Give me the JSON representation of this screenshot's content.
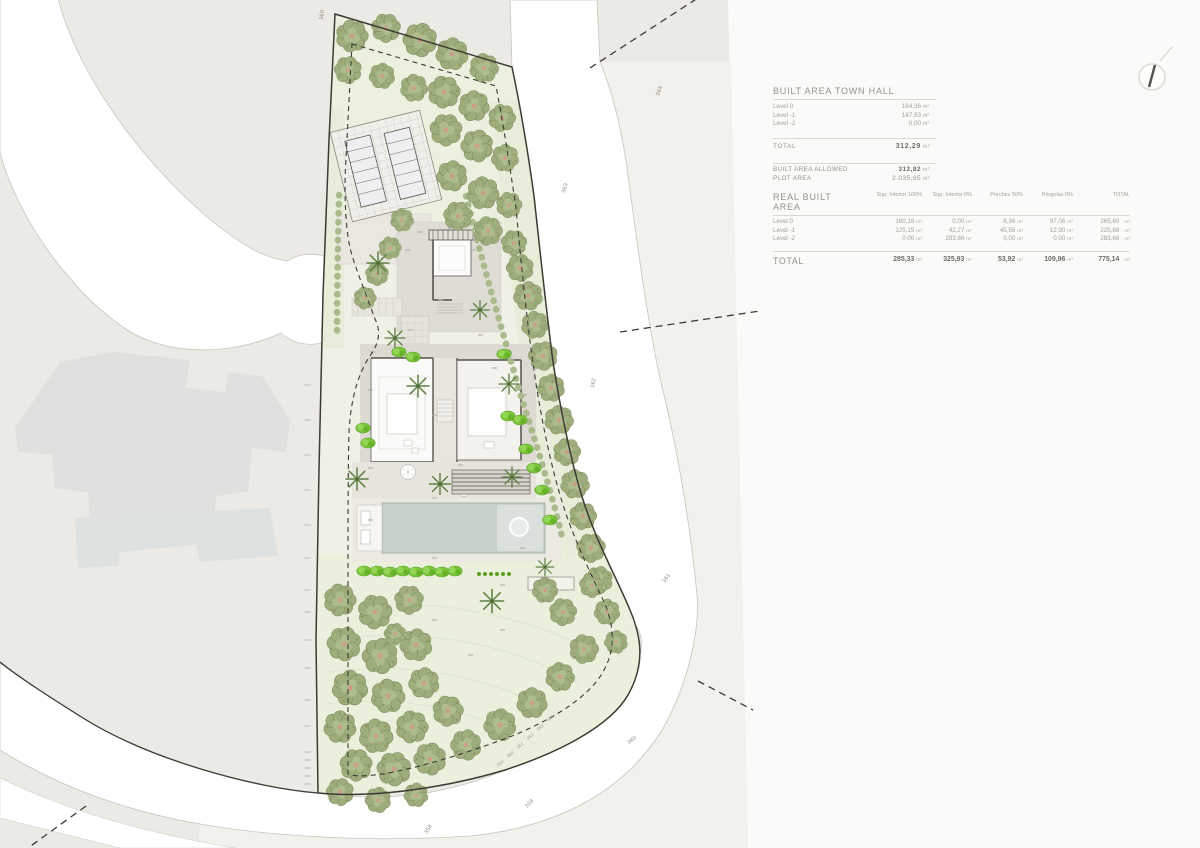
{
  "panel": {
    "unit": "m²",
    "town_hall": {
      "title": "BUILT AREA TOWN HALL",
      "rows": [
        {
          "label": "Level 0",
          "value": "164,36"
        },
        {
          "label": "Level -1",
          "value": "147,93"
        },
        {
          "label": "Level -2",
          "value": "0,00"
        }
      ],
      "total_label": "TOTAL",
      "total_value": "312,29",
      "allowed_label": "BUILT AREA ALLOWED",
      "allowed_value": "312,82",
      "plot_label": "PLOT AREA",
      "plot_value": "2.035,85"
    },
    "real": {
      "title": "REAL BUILT AREA",
      "columns": [
        "Sup. Interior 100%",
        "Sup. Interior 0%",
        "Porches 50%",
        "Pérgolas 0%",
        "TOTAL"
      ],
      "rows": [
        {
          "label": "Level 0",
          "values": [
            "160,18",
            "0,00",
            "8,36",
            "97,06",
            "265,60"
          ]
        },
        {
          "label": "Level -1",
          "values": [
            "125,15",
            "42,27",
            "45,56",
            "12,90",
            "225,88"
          ]
        },
        {
          "label": "Level -2",
          "values": [
            "0,00",
            "283,66",
            "0,00",
            "0,00",
            "283,66"
          ]
        }
      ],
      "total": {
        "label": "TOTAL",
        "values": [
          "285,33",
          "325,93",
          "53,92",
          "109,96",
          "775,14"
        ]
      }
    }
  },
  "plan": {
    "road_contours": [
      "360",
      "364",
      "363",
      "362",
      "361",
      "360",
      "359",
      "358"
    ],
    "setback_contours": [
      "359",
      "360",
      "361",
      "362",
      "363",
      "364"
    ]
  },
  "colors": {
    "terrain": "#ECEAE4",
    "plot_green": "#EFF1E6",
    "tree_foliage": "#9DAD7C",
    "shrub_lime": "#7DC63C",
    "pool_water": "#C7D1CA",
    "boundary_ink": "#3C3A34"
  }
}
